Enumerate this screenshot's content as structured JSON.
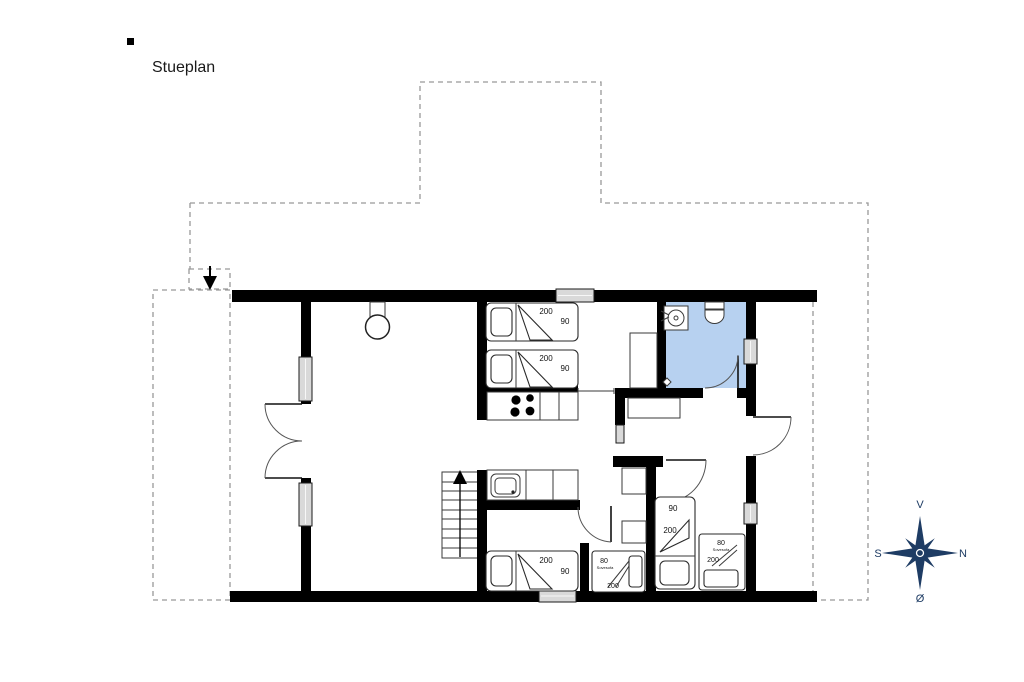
{
  "title": "Stueplan",
  "beds": {
    "top1": {
      "length": "200",
      "width": "90"
    },
    "top2": {
      "length": "200",
      "width": "90"
    },
    "bottom_left": {
      "length": "200",
      "width": "90"
    },
    "middle_sofa": {
      "width": "80",
      "type": "Sovesofa",
      "length": "200"
    },
    "right_bed": {
      "width": "90",
      "length": "200"
    },
    "right_sofa": {
      "width": "80",
      "type": "Sovesofa",
      "length": "200"
    }
  },
  "compass": {
    "top": "V",
    "right": "N",
    "left": "S",
    "bottom": "Ø"
  },
  "colors": {
    "wall": "#000000",
    "bathroom_fill": "#b7d1f0",
    "window_fill": "#d9d9d9",
    "compass": "#1e3c64",
    "dashed_outline": "#999999"
  }
}
